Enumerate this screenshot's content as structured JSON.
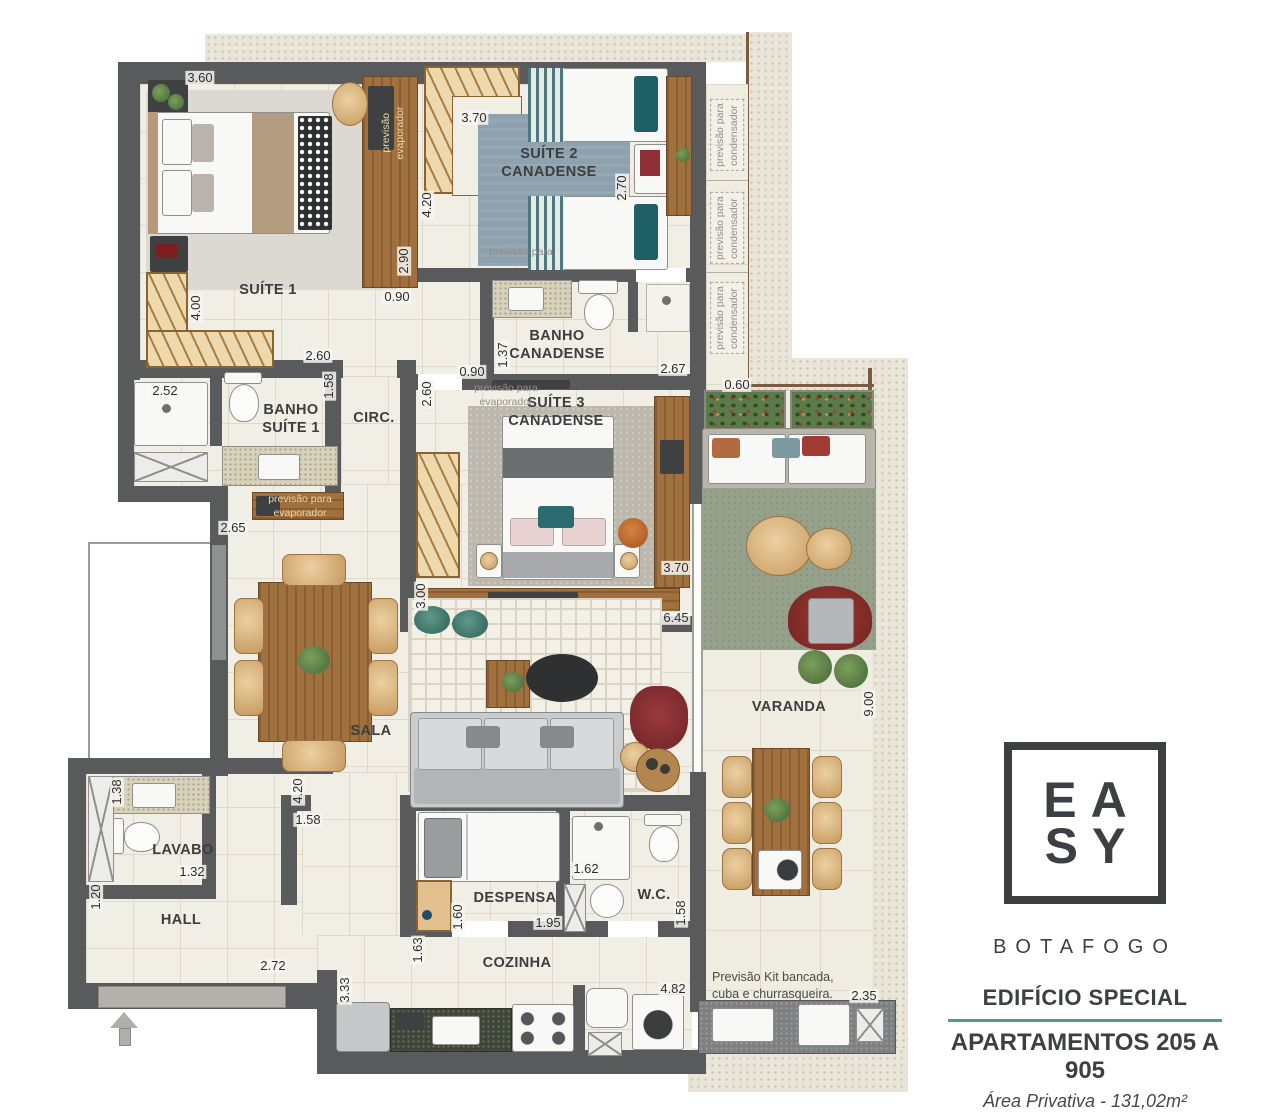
{
  "branding": {
    "logo_line1": "EA",
    "logo_line2": "SY",
    "city": "BOTAFOGO",
    "building": "EDIFÍCIO SPECIAL",
    "apartments": "APARTAMENTOS 205 A 905",
    "area": "Área Privativa - 131,02m²",
    "accent_color": "#4e9a8e",
    "wall_color": "#595a5c"
  },
  "plan": {
    "rooms": [
      {
        "name": "room-label-suite-1",
        "label": "SUÍTE 1",
        "x": 268,
        "y": 290
      },
      {
        "name": "room-label-suite-2",
        "label": "SUÍTE 2\nCANADENSE",
        "x": 549,
        "y": 163
      },
      {
        "name": "room-label-banho-canadense",
        "label": "BANHO\nCANADENSE",
        "x": 557,
        "y": 345
      },
      {
        "name": "room-label-banho-suite-1",
        "label": "BANHO\nSUÍTE 1",
        "x": 291,
        "y": 419
      },
      {
        "name": "room-label-circ",
        "label": "CIRC.",
        "x": 374,
        "y": 418
      },
      {
        "name": "room-label-suite-3",
        "label": "SUÍTE 3\nCANADENSE",
        "x": 556,
        "y": 412
      },
      {
        "name": "room-label-sala",
        "label": "SALA",
        "x": 371,
        "y": 731
      },
      {
        "name": "room-label-varanda",
        "label": "VARANDA",
        "x": 789,
        "y": 707
      },
      {
        "name": "room-label-lavabo",
        "label": "LAVABO",
        "x": 183,
        "y": 850
      },
      {
        "name": "room-label-hall",
        "label": "HALL",
        "x": 181,
        "y": 920
      },
      {
        "name": "room-label-despensa",
        "label": "DESPENSA",
        "x": 515,
        "y": 898
      },
      {
        "name": "room-label-wc",
        "label": "W.C.",
        "x": 654,
        "y": 895
      },
      {
        "name": "room-label-cozinha",
        "label": "COZINHA",
        "x": 517,
        "y": 963
      }
    ],
    "dimensions": [
      {
        "name": "dim",
        "text": "3.60",
        "x": 200,
        "y": 78
      },
      {
        "name": "dim",
        "text": "3.70",
        "x": 474,
        "y": 118
      },
      {
        "name": "dim",
        "text": "4.20",
        "x": 427,
        "y": 205,
        "v": true
      },
      {
        "name": "dim",
        "text": "2.70",
        "x": 622,
        "y": 188,
        "v": true
      },
      {
        "name": "dim",
        "text": "2.90",
        "x": 404,
        "y": 261,
        "v": true
      },
      {
        "name": "dim",
        "text": "0.90",
        "x": 397,
        "y": 297
      },
      {
        "name": "dim",
        "text": "4.00",
        "x": 196,
        "y": 308,
        "v": true
      },
      {
        "name": "dim",
        "text": "2.60",
        "x": 318,
        "y": 356
      },
      {
        "name": "dim",
        "text": "1.58",
        "x": 329,
        "y": 386,
        "v": true
      },
      {
        "name": "dim",
        "text": "2.52",
        "x": 165,
        "y": 391
      },
      {
        "name": "dim",
        "text": "1.37",
        "x": 503,
        "y": 355,
        "v": true
      },
      {
        "name": "dim",
        "text": "0.90",
        "x": 472,
        "y": 372
      },
      {
        "name": "dim",
        "text": "2.67",
        "x": 673,
        "y": 369
      },
      {
        "name": "dim",
        "text": "0.60",
        "x": 737,
        "y": 385
      },
      {
        "name": "dim",
        "text": "2.60",
        "x": 427,
        "y": 394,
        "v": true
      },
      {
        "name": "dim",
        "text": "2.65",
        "x": 233,
        "y": 528
      },
      {
        "name": "dim",
        "text": "3.70",
        "x": 676,
        "y": 568
      },
      {
        "name": "dim",
        "text": "3.00",
        "x": 421,
        "y": 596,
        "v": true
      },
      {
        "name": "dim",
        "text": "6.45",
        "x": 676,
        "y": 618
      },
      {
        "name": "dim",
        "text": "9.00",
        "x": 869,
        "y": 704,
        "v": true
      },
      {
        "name": "dim",
        "text": "4.20",
        "x": 298,
        "y": 791,
        "v": true
      },
      {
        "name": "dim",
        "text": "1.58",
        "x": 308,
        "y": 820
      },
      {
        "name": "dim",
        "text": "1.38",
        "x": 117,
        "y": 792,
        "v": true
      },
      {
        "name": "dim",
        "text": "1.32",
        "x": 192,
        "y": 872
      },
      {
        "name": "dim",
        "text": "1.20",
        "x": 96,
        "y": 897,
        "v": true
      },
      {
        "name": "dim",
        "text": "2.72",
        "x": 273,
        "y": 966
      },
      {
        "name": "dim",
        "text": "1.60",
        "x": 458,
        "y": 917,
        "v": true
      },
      {
        "name": "dim",
        "text": "1.95",
        "x": 548,
        "y": 923
      },
      {
        "name": "dim",
        "text": "1.62",
        "x": 586,
        "y": 869
      },
      {
        "name": "dim",
        "text": "1.58",
        "x": 681,
        "y": 913,
        "v": true
      },
      {
        "name": "dim",
        "text": "1.63",
        "x": 418,
        "y": 950,
        "v": true
      },
      {
        "name": "dim",
        "text": "3.33",
        "x": 345,
        "y": 990,
        "v": true
      },
      {
        "name": "dim",
        "text": "4.82",
        "x": 673,
        "y": 989
      },
      {
        "name": "dim",
        "text": "2.35",
        "x": 864,
        "y": 996
      }
    ],
    "annotations": [
      {
        "name": "annotation-condenser-1",
        "text": "previsão para\ncondensador",
        "x": 727,
        "y": 135,
        "v": true,
        "cls": "box"
      },
      {
        "name": "annotation-condenser-2",
        "text": "previsão para\ncondensador",
        "x": 727,
        "y": 228,
        "v": true,
        "cls": "box"
      },
      {
        "name": "annotation-condenser-3",
        "text": "previsão para\ncondensador",
        "x": 727,
        "y": 318,
        "v": true,
        "cls": "box"
      },
      {
        "name": "annotation-evaporator-suite1",
        "text": "previsão\nevaporador",
        "x": 393,
        "y": 133,
        "v": true,
        "cls": "woodtxt"
      },
      {
        "name": "annotation-evaporator-suite2",
        "text": "previsão para",
        "x": 521,
        "y": 252
      },
      {
        "name": "annotation-evaporator-shelf",
        "text": "previsão para\nevaporador",
        "x": 300,
        "y": 506,
        "cls": "woodtxt"
      },
      {
        "name": "annotation-evaporator-suite3",
        "text": "previsão para\nevaporador",
        "x": 506,
        "y": 395
      },
      {
        "name": "annotation-kit-bancada",
        "text": "Previsão Kit bancada,\ncuba e churrasqueira.",
        "x": 712,
        "y": 986,
        "cls": "darktxt"
      }
    ]
  }
}
